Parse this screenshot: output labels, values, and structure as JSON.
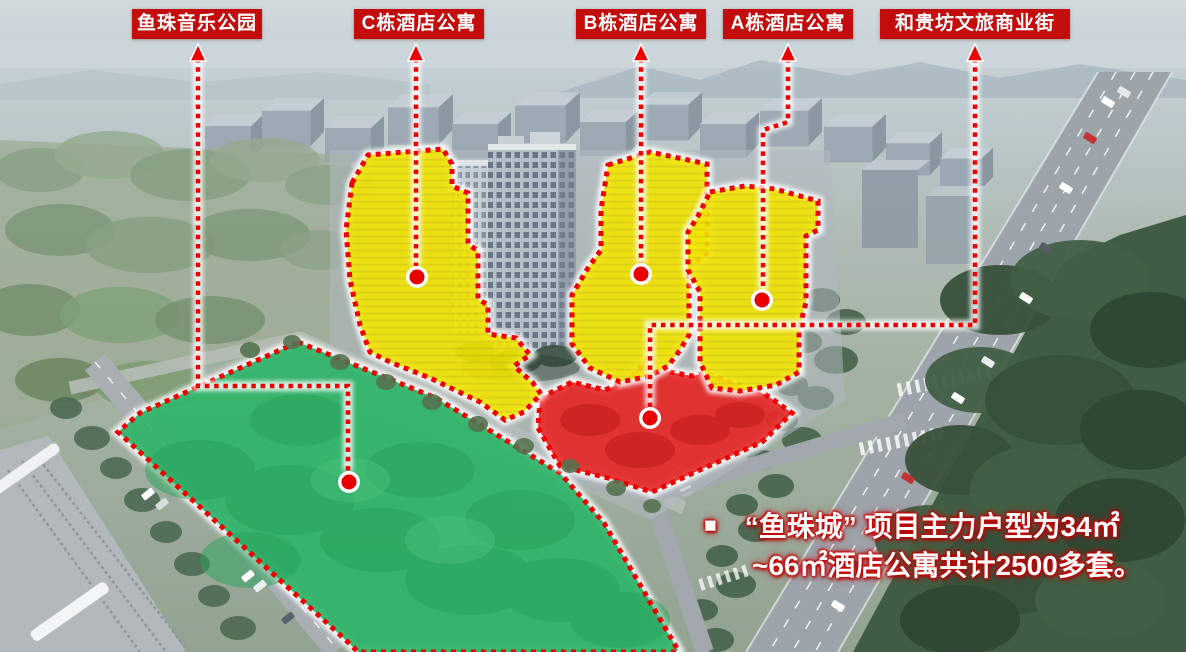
{
  "labels": [
    {
      "name": "yuzhu-music-park",
      "text": "鱼珠音乐公园"
    },
    {
      "name": "building-c",
      "text": "C栋酒店公寓"
    },
    {
      "name": "building-b",
      "text": "B栋酒店公寓"
    },
    {
      "name": "building-a",
      "text": "A栋酒店公寓"
    },
    {
      "name": "heguifang-street",
      "text": "和贵坊文旅商业街"
    }
  ],
  "caption": {
    "bullet": "■",
    "line1": "“鱼珠城” 项目主力户型为34㎡",
    "line2": "~66㎡酒店公寓共计2500多套。"
  },
  "zones": [
    {
      "name": "music-park-zone",
      "label": "鱼珠音乐公园",
      "color": "#2eb469"
    },
    {
      "name": "building-c-zone",
      "label": "C栋酒店公寓",
      "color": "#f2e500"
    },
    {
      "name": "building-b-zone",
      "label": "B栋酒店公寓",
      "color": "#f2e500"
    },
    {
      "name": "building-a-zone",
      "label": "A栋酒店公寓",
      "color": "#f2e500"
    },
    {
      "name": "heguifang-zone",
      "label": "和贵坊文旅商业街",
      "color": "#e52323"
    }
  ],
  "colors": {
    "label_bg": "#c30d0d",
    "label_text": "#ffffff",
    "line_red": "#ee0000",
    "zone_yellow": "#f2e500",
    "zone_red": "#e52323",
    "zone_green": "#2eb469",
    "caption_text": "#ffffff",
    "caption_glow": "#cc0000"
  }
}
